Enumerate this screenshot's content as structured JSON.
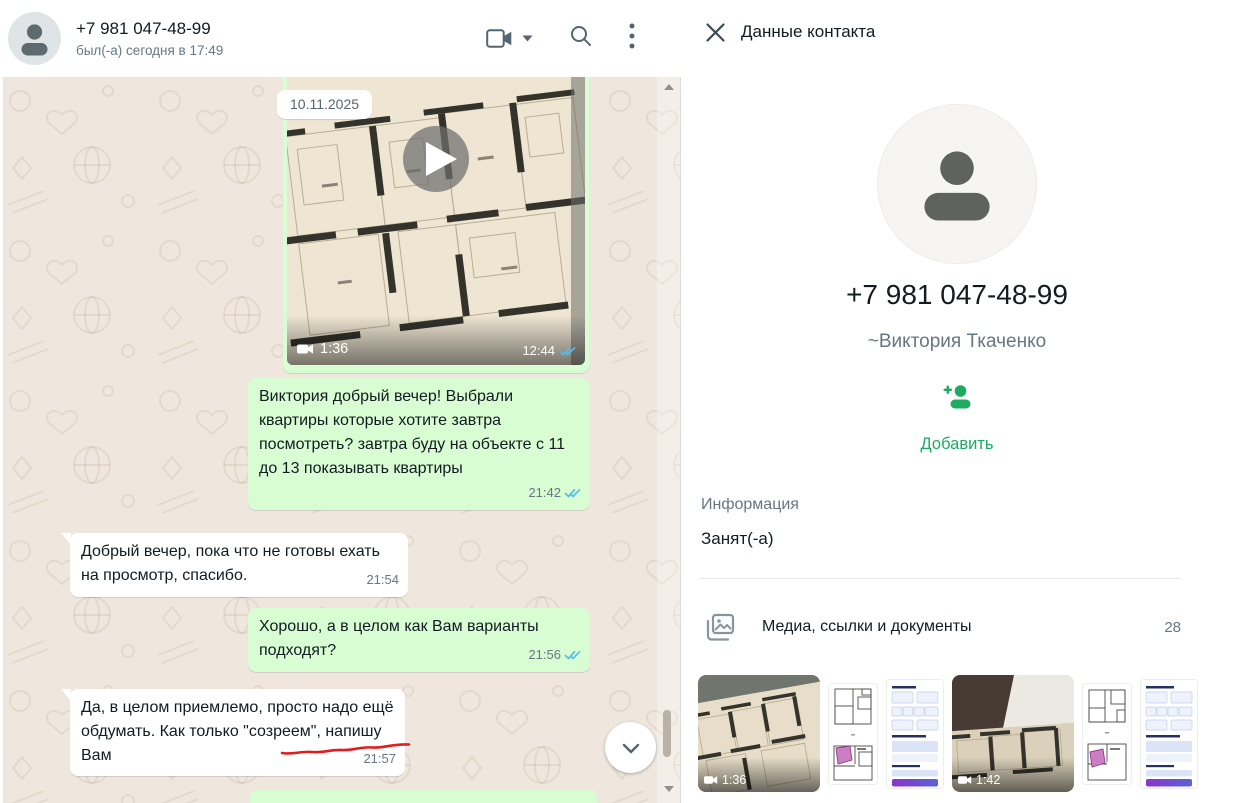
{
  "colors": {
    "accent_green": "#1daa61",
    "bubble_outgoing": "#d9fdd3",
    "bubble_incoming": "#ffffff",
    "read_check_blue": "#53bdeb",
    "chat_background": "#efe7de",
    "text_primary": "#111b21",
    "text_secondary": "#667781",
    "annotation_red": "#e11d1d"
  },
  "chat": {
    "header": {
      "phone": "+7 981 047-48-99",
      "status": "был(-а) сегодня в 17:49"
    },
    "date_chip": "10.11.2025",
    "video_message": {
      "direction": "out",
      "duration": "1:36",
      "time": "12:44",
      "status": "read"
    },
    "messages": [
      {
        "direction": "out",
        "text": "Виктория добрый вечер! Выбрали квартиры которые хотите завтра посмотреть? завтра буду на объекте с 11 до 13 показывать квартиры",
        "time": "21:42",
        "status": "read"
      },
      {
        "direction": "in",
        "text": "Добрый вечер, пока что не готовы ехать на просмотр, спасибо.",
        "time": "21:54"
      },
      {
        "direction": "out",
        "text": "Хорошо, а в целом как Вам варианты подходят?",
        "time": "21:56",
        "status": "read"
      },
      {
        "direction": "in",
        "text": "Да, в целом приемлемо, просто надо ещё обдумать. Как только \"созреем\", напишу Вам",
        "time": "21:57"
      }
    ]
  },
  "contact_panel": {
    "title": "Данные контакта",
    "phone": "+7 981 047-48-99",
    "name": "~Виктория Ткаченко",
    "add_label": "Добавить",
    "info_label": "Информация",
    "about": "Занят(-а)",
    "media": {
      "label": "Медиа, ссылки и документы",
      "count": "28",
      "thumbnails": [
        {
          "type": "video",
          "desc": "floor-plan video",
          "duration": "1:36"
        },
        {
          "type": "image",
          "desc": "floor-plan drawing"
        },
        {
          "type": "image",
          "desc": "listing document"
        },
        {
          "type": "video",
          "desc": "floor-plan video",
          "duration": "1:42"
        },
        {
          "type": "image",
          "desc": "floor-plan drawing"
        },
        {
          "type": "image",
          "desc": "listing document"
        }
      ]
    }
  },
  "icons": {
    "video_call": "video-camera",
    "video_call_options": "chevron-down",
    "search": "magnifier",
    "menu": "kebab-menu",
    "close": "x",
    "play": "play-triangle",
    "read_receipt": "double-check",
    "scroll_to_bottom": "chevron-down",
    "add_contact": "person-plus",
    "media_section": "photos-stack",
    "default_avatar": "person-silhouette"
  }
}
